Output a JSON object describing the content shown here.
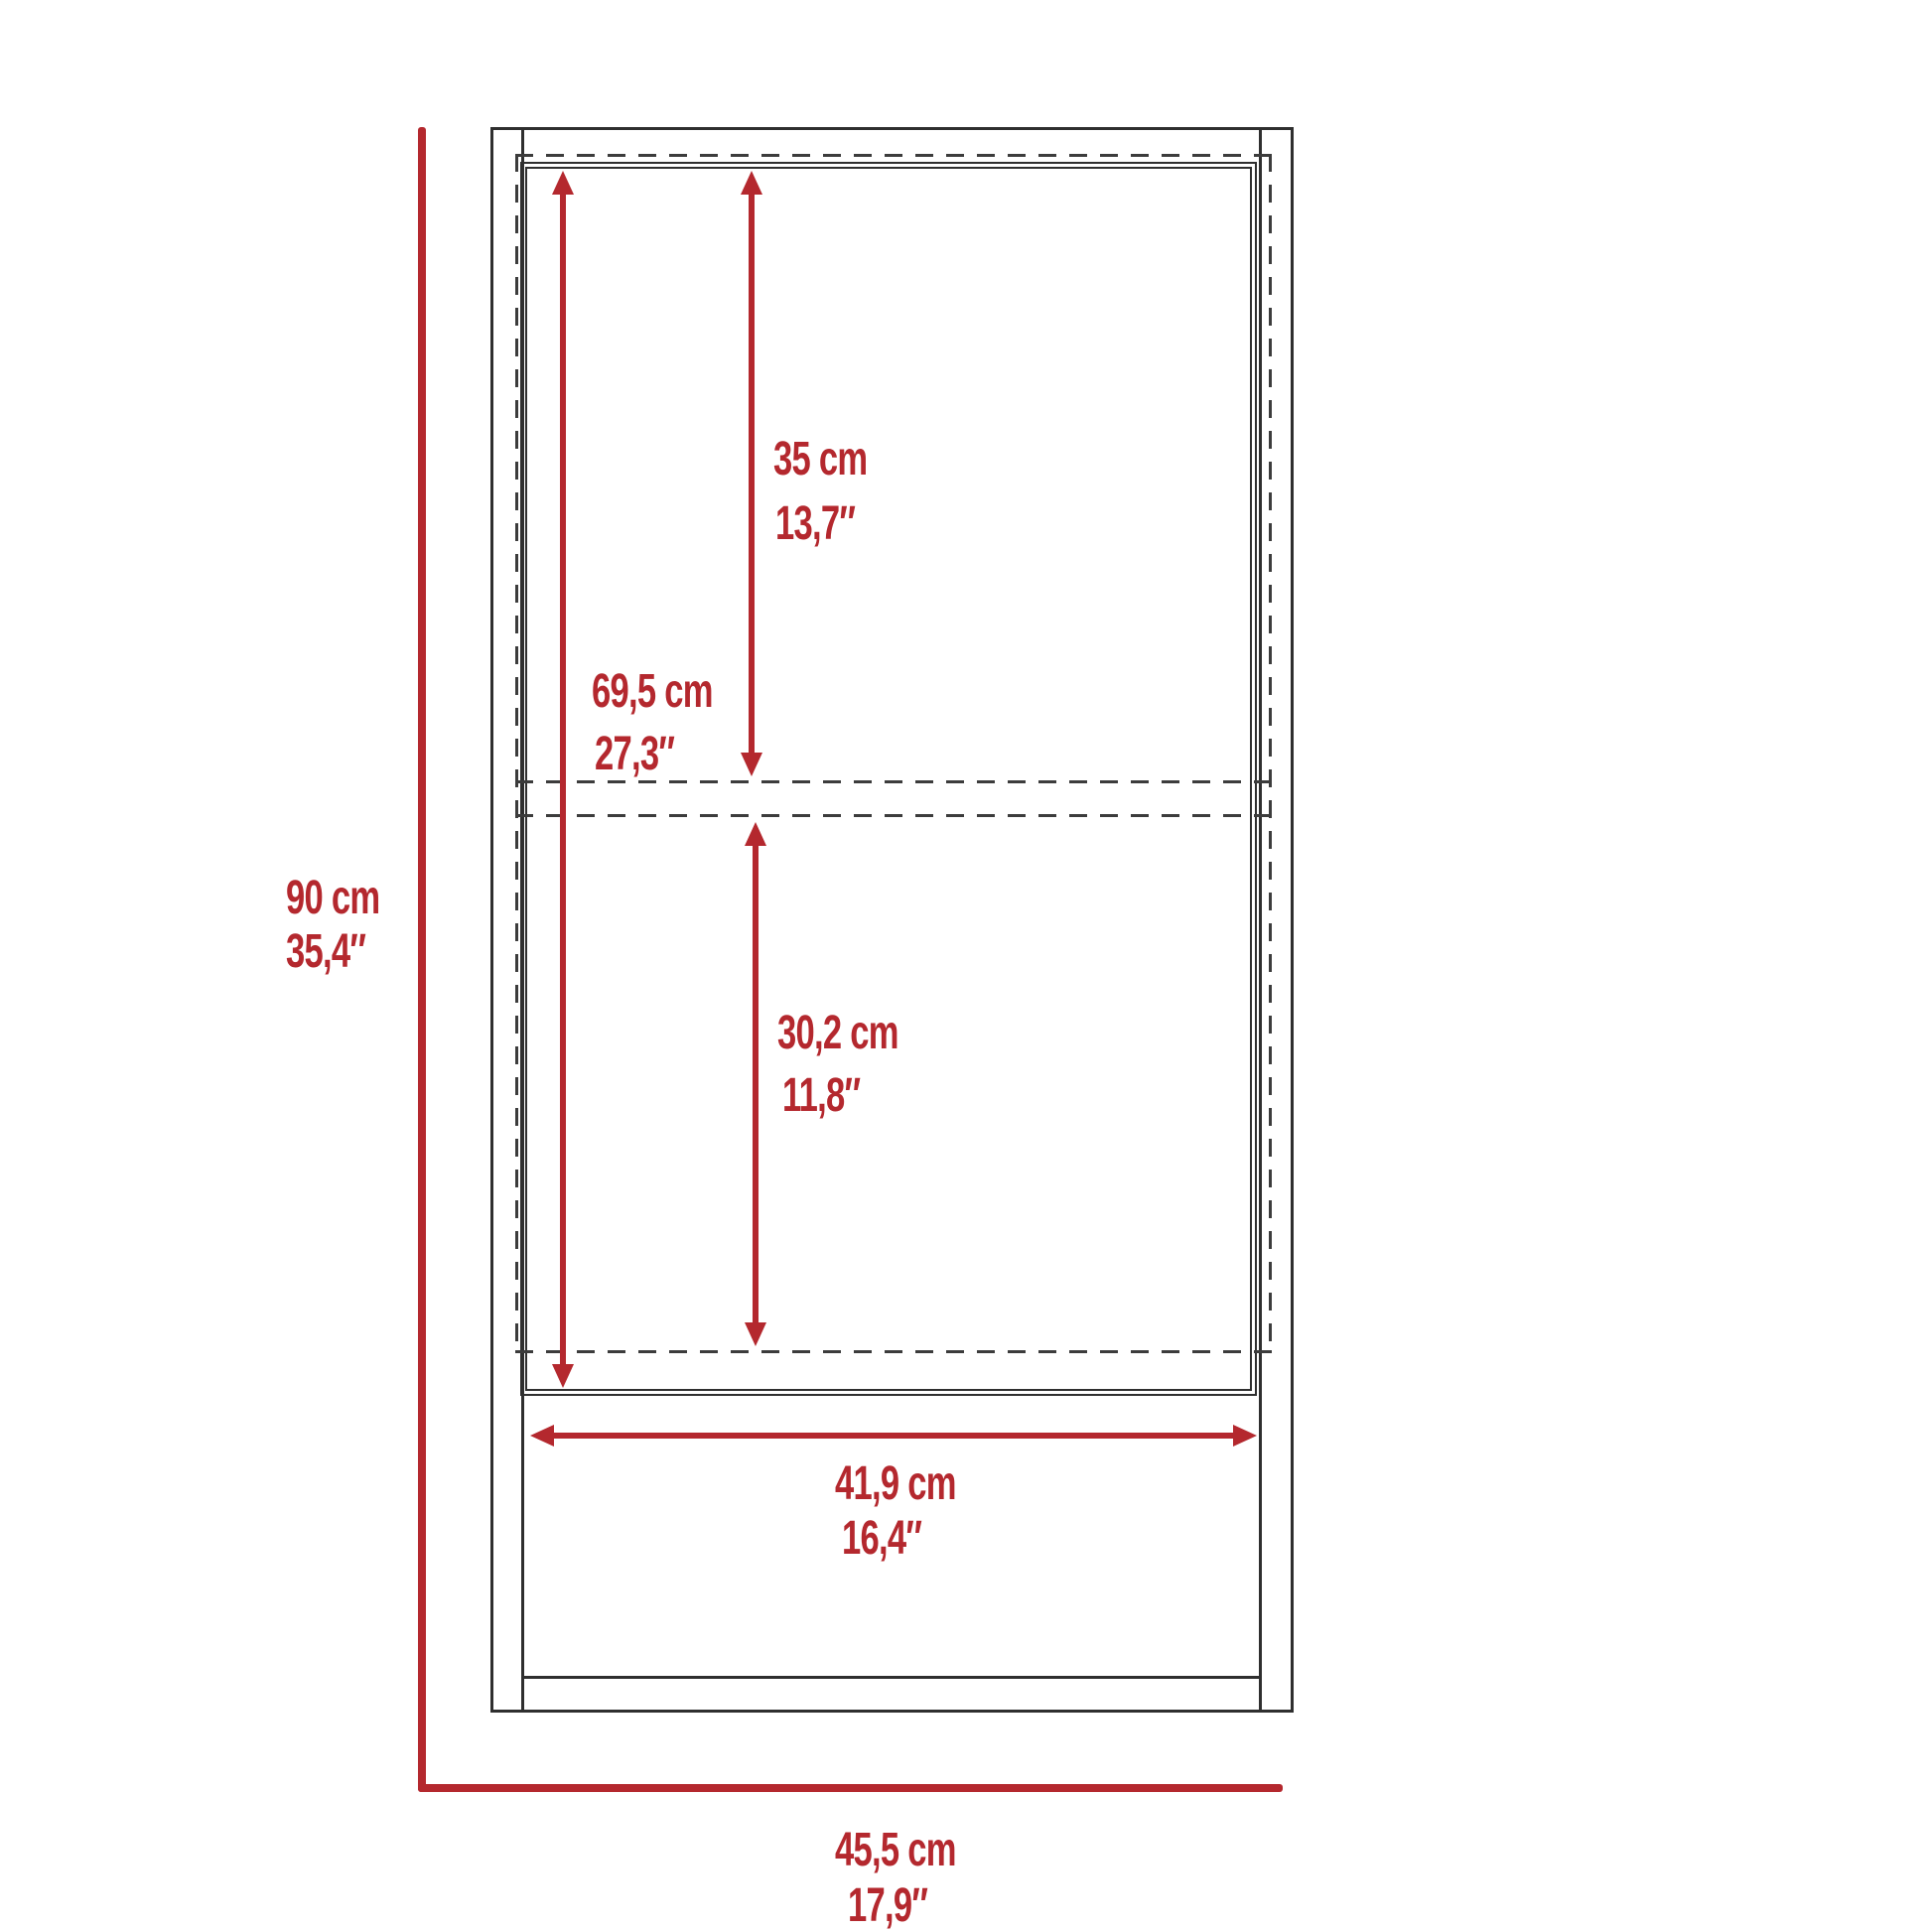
{
  "diagram": {
    "title": "cabinet-dimension-drawing",
    "colors": {
      "dimension_red": "#b4282e",
      "outline_black": "#2f2f2f",
      "hidden_line_gray": "#3c3c3c",
      "background": "#ffffff"
    },
    "labels": {
      "upper_section_height": {
        "cm": "35 cm",
        "in": "13,7″"
      },
      "door_height": {
        "cm": "69,5 cm",
        "in": "27,3″"
      },
      "lower_section_height": {
        "cm": "30,2 cm",
        "in": "11,8″"
      },
      "overall_height": {
        "cm": "90 cm",
        "in": "35,4″"
      },
      "interior_width": {
        "cm": "41,9 cm",
        "in": "16,4″"
      },
      "overall_width": {
        "cm": "45,5 cm",
        "in": "17,9″"
      }
    }
  }
}
